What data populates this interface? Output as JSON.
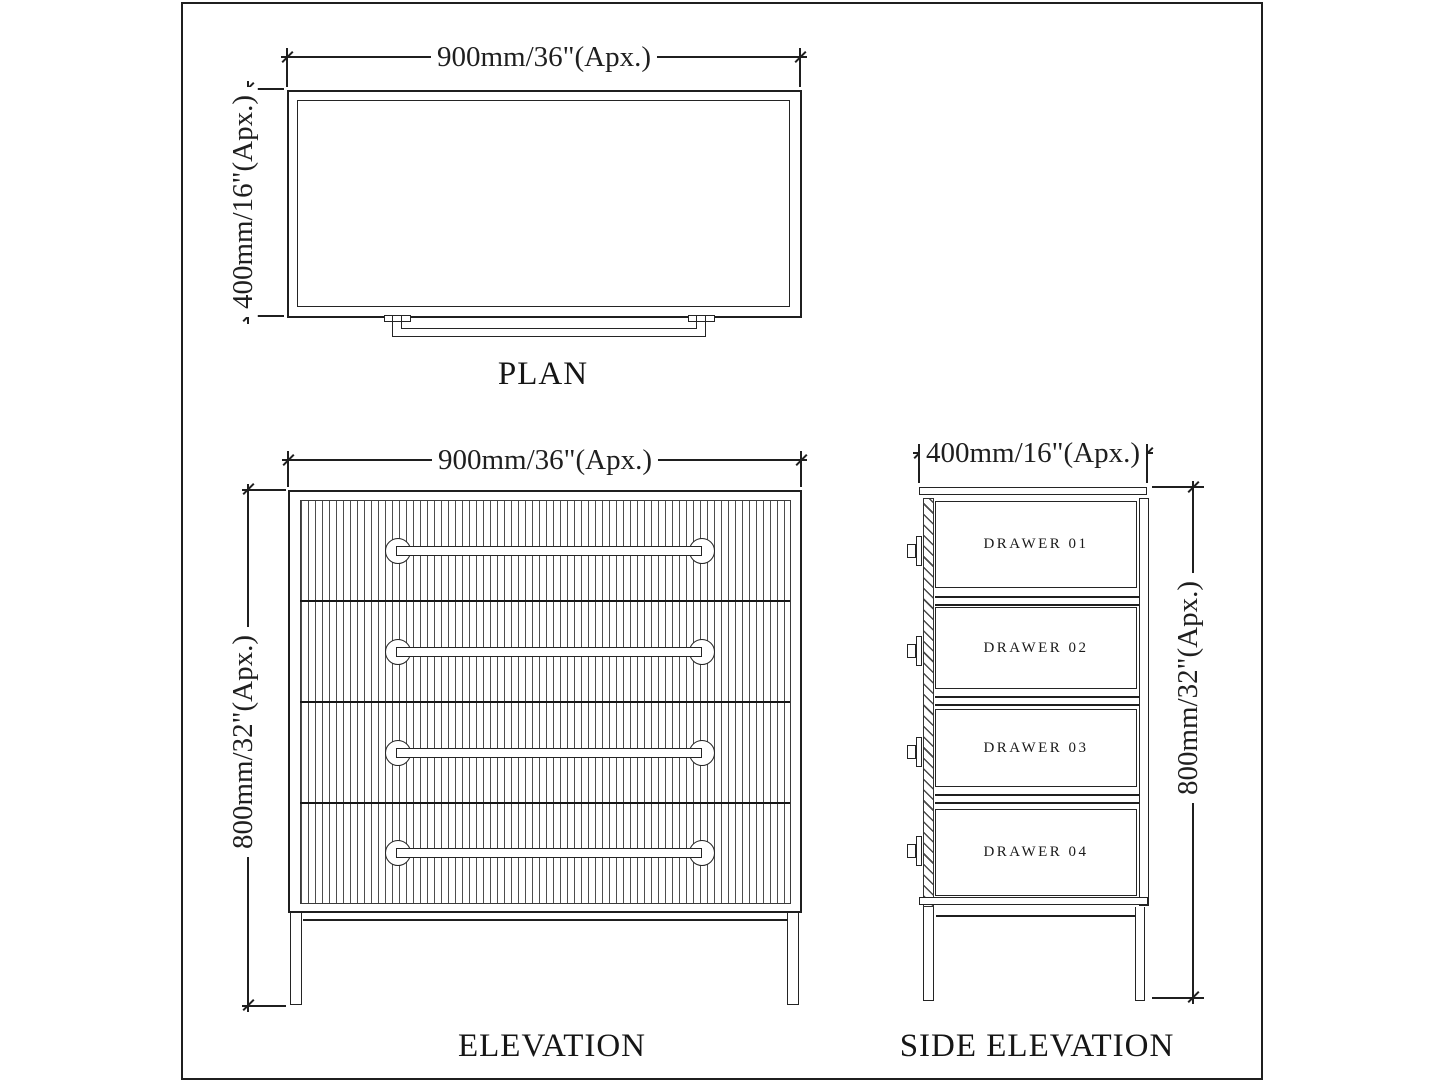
{
  "page": {
    "background": "#ffffff",
    "line_color": "#1f1f1f"
  },
  "plan": {
    "title": "PLAN",
    "width_dim": "900mm/36\"(Apx.)",
    "depth_dim": "400mm/16\"(Apx.)"
  },
  "elevation": {
    "title": "ELEVATION",
    "width_dim": "900mm/36\"(Apx.)",
    "height_dim": "800mm/32\"(Apx.)"
  },
  "side_elevation": {
    "title": "SIDE ELEVATION",
    "depth_dim": "400mm/16\"(Apx.)",
    "height_dim": "800mm/32\"(Apx.)",
    "drawers": [
      {
        "label": "DRAWER 01"
      },
      {
        "label": "DRAWER 02"
      },
      {
        "label": "DRAWER 03"
      },
      {
        "label": "DRAWER 04"
      }
    ]
  }
}
